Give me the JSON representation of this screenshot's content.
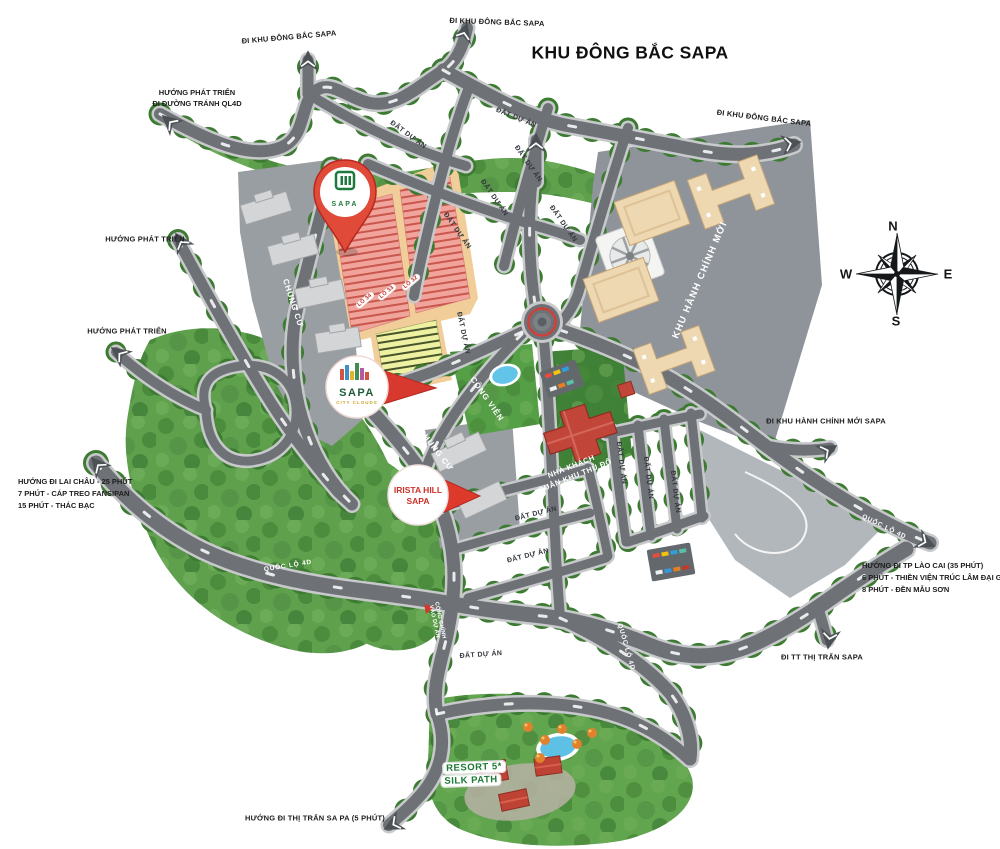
{
  "title": "KHU ĐÔNG BẮC SAPA",
  "compass": {
    "n": "N",
    "e": "E",
    "s": "S",
    "w": "W"
  },
  "directions": {
    "top_left": "ĐI KHU ĐÔNG BẮC SAPA",
    "top_center": "ĐI KHU ĐÔNG BẮC SAPA",
    "top_right": "ĐI KHU ĐÔNG BẮC SAPA",
    "dev_line1": "HƯỚNG PHÁT TRIỂN",
    "dev_line2": "ĐI ĐƯỜNG TRÁNH QL4D",
    "dev2": "HƯỚNG PHÁT TRIỂN",
    "dev3": "HƯỚNG PHÁT TRIỂN",
    "lai_chau": [
      "HƯỚNG ĐI LAI CHÂU - 25 PHÚT",
      "7 PHÚT - CÁP TREO FANSIPAN",
      "15 PHÚT - THÁC BẠC"
    ],
    "lao_cai": [
      "HƯỚNG ĐI TP LÀO CAI (35 PHÚT)",
      "6 PHÚT - THIỀN VIỆN TRÚC LÂM ĐẠI GIÁC",
      "8 PHÚT - ĐỀN MẪU SƠN"
    ],
    "admin_exit": "ĐI KHU HÀNH CHÍNH MỚI SAPA",
    "town_exit": "ĐI TT THỊ TRẤN SAPA",
    "town_south": "HƯỚNG ĐI THỊ TRẤN SA PA (5 PHÚT)"
  },
  "areas": {
    "admin": "KHU HÀNH CHÍNH MỚI",
    "park": "CÔNG VIÊN",
    "guesthouse_line1": "NHÀ KHÁCH",
    "guesthouse_line2": "QUÂN KHU THỦ ĐÔ",
    "apartment": "CHUNG CƯ",
    "project_land": "ĐẤT DỰ ÁN",
    "main_gate_line1": "CỔNG CHÍNH",
    "main_gate_line2": "VÀO DỰ ÁN",
    "resort_line1": "RESORT 5*",
    "resort_line2": "SILK PATH"
  },
  "roads": {
    "highway": "QUỐC LỘ 4D"
  },
  "lots": {
    "lo32": "LÔ 32",
    "lo33": "LÔ 33",
    "lo34": "LÔ 34"
  },
  "pins": {
    "sapa_logo": {
      "name": "SAPA"
    },
    "sapa_city_clouds": {
      "name": "SAPA",
      "sub": "CITY CLOUDS"
    },
    "irista": {
      "line1": "IRISTA HILL",
      "line2": "SAPA"
    }
  },
  "colors": {
    "road": "#6e7277",
    "forest": "#5fa04c",
    "accent_red": "#d8392e",
    "plot_salmon": "#f0a49b",
    "plot_yellow": "#eef0a2",
    "admin_gray": "#8f949a"
  }
}
